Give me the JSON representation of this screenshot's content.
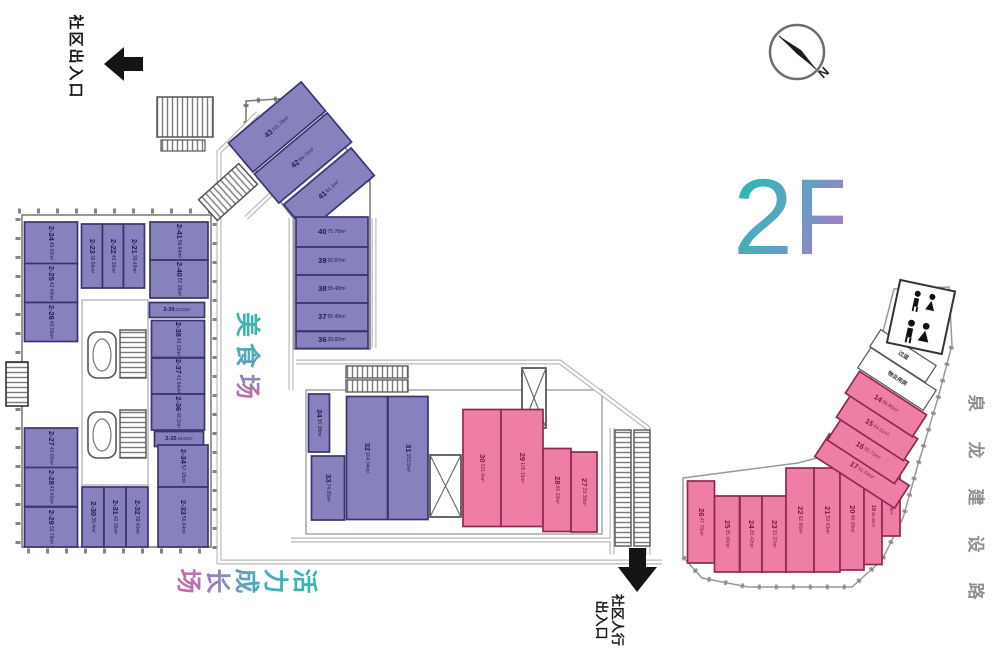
{
  "legend": {
    "floor_label": "2F",
    "north_label": "N",
    "entrance_top": "社区出入口",
    "entrance_bottom_line1": "社区人行",
    "entrance_bottom_line2": "出入口",
    "road_name": "泉龙建设路",
    "zone_food": "美食场",
    "zone_growth": "活力成长场"
  },
  "colors": {
    "purple_fill": "#8781bd",
    "purple_border": "#3c3470",
    "purple_text": "#221c4a",
    "pink_fill": "#ef7ea7",
    "pink_border": "#8e2a50",
    "pink_text": "#741c3c",
    "teal_accent": "#2eb8b0",
    "pink_accent": "#d1679e"
  },
  "plan": {
    "units": [
      {
        "label": "43",
        "area": "111.73m²",
        "color": "purple",
        "cx": 277,
        "cy": 127,
        "w": 95,
        "h": 38,
        "srot": -40,
        "lrot": -40
      },
      {
        "label": "42",
        "area": "64.71m²",
        "color": "purple",
        "cx": 303,
        "cy": 158,
        "w": 95,
        "h": 38,
        "srot": -40,
        "lrot": -40
      },
      {
        "label": "41",
        "area": "61.1m²",
        "color": "purple",
        "cx": 329,
        "cy": 190,
        "w": 88,
        "h": 36,
        "srot": -40,
        "lrot": -40
      },
      {
        "label": "40",
        "area": "75.76m²",
        "color": "purple",
        "cx": 332,
        "cy": 232,
        "w": 72,
        "h": 30,
        "lrot": 0
      },
      {
        "label": "39",
        "area": "56.87m²",
        "color": "purple",
        "cx": 332,
        "cy": 261,
        "w": 72,
        "h": 28,
        "lrot": 0
      },
      {
        "label": "38",
        "area": "55.48m²",
        "color": "purple",
        "cx": 332,
        "cy": 289,
        "w": 72,
        "h": 28,
        "lrot": 0
      },
      {
        "label": "37",
        "area": "55.49m²",
        "color": "purple",
        "cx": 332,
        "cy": 317,
        "w": 72,
        "h": 28,
        "lrot": 0
      },
      {
        "label": "36",
        "area": "39.82m²",
        "color": "purple",
        "cx": 332,
        "cy": 340,
        "w": 72,
        "h": 17,
        "lrot": 0
      },
      {
        "label": "2-24",
        "area": "49.92m²",
        "color": "purple",
        "cx": 51,
        "cy": 243,
        "w": 53,
        "h": 42,
        "lrot": 90
      },
      {
        "label": "2-23",
        "area": "39.56m²",
        "color": "purple",
        "cx": 92,
        "cy": 256,
        "w": 21,
        "h": 64,
        "lrot": 90
      },
      {
        "label": "2-22",
        "area": "40.35m²",
        "color": "purple",
        "cx": 113,
        "cy": 256,
        "w": 21,
        "h": 64,
        "lrot": 90
      },
      {
        "label": "2-21",
        "area": "39.49m²",
        "color": "purple",
        "cx": 134,
        "cy": 256,
        "w": 21,
        "h": 64,
        "lrot": 90
      },
      {
        "label": "2-41",
        "area": "56.64m²",
        "color": "purple",
        "cx": 179,
        "cy": 241,
        "w": 58,
        "h": 38,
        "lrot": 90
      },
      {
        "label": "2-40",
        "area": "57.35m²",
        "color": "purple",
        "cx": 179,
        "cy": 279,
        "w": 58,
        "h": 38,
        "lrot": 90
      },
      {
        "label": "2-39",
        "area": "22.02m²",
        "color": "purple",
        "cx": 177,
        "cy": 310,
        "w": 55,
        "h": 15,
        "lrot": 0,
        "small": true
      },
      {
        "label": "2-38",
        "area": "42.12m²",
        "color": "purple",
        "cx": 178,
        "cy": 339,
        "w": 53,
        "h": 37,
        "lrot": 90
      },
      {
        "label": "2-37",
        "area": "41.64m²",
        "color": "purple",
        "cx": 178,
        "cy": 376,
        "w": 53,
        "h": 36,
        "lrot": 90
      },
      {
        "label": "2-36",
        "area": "42.2m²",
        "color": "purple",
        "cx": 178,
        "cy": 412,
        "w": 53,
        "h": 36,
        "lrot": 90
      },
      {
        "label": "2-35",
        "area": "19.02m²",
        "color": "purple",
        "cx": 179,
        "cy": 439,
        "w": 49,
        "h": 15,
        "lrot": 0,
        "small": true
      },
      {
        "label": "2-25",
        "area": "42.40m²",
        "color": "purple",
        "cx": 51,
        "cy": 283,
        "w": 53,
        "h": 39,
        "lrot": 90
      },
      {
        "label": "2-26",
        "area": "40.00m²",
        "color": "purple",
        "cx": 51,
        "cy": 322,
        "w": 53,
        "h": 39,
        "lrot": 90
      },
      {
        "label": "2-27",
        "area": "40.00m²",
        "color": "purple",
        "cx": 51,
        "cy": 448,
        "w": 53,
        "h": 40,
        "lrot": 90
      },
      {
        "label": "2-28",
        "area": "42.40m²",
        "color": "purple",
        "cx": 51,
        "cy": 487,
        "w": 53,
        "h": 39,
        "lrot": 90
      },
      {
        "label": "2-29",
        "area": "33.79m²",
        "color": "purple",
        "cx": 51,
        "cy": 527,
        "w": 53,
        "h": 40,
        "lrot": 90
      },
      {
        "label": "2-30",
        "area": "39.4m²",
        "color": "purple",
        "cx": 93,
        "cy": 517,
        "w": 22,
        "h": 60,
        "lrot": 90
      },
      {
        "label": "2-31",
        "area": "42.35m²",
        "color": "purple",
        "cx": 115,
        "cy": 517,
        "w": 22,
        "h": 60,
        "lrot": 90
      },
      {
        "label": "2-32",
        "area": "39.40m²",
        "color": "purple",
        "cx": 137,
        "cy": 517,
        "w": 22,
        "h": 60,
        "lrot": 90
      },
      {
        "label": "2-34",
        "area": "57.15m²",
        "color": "purple",
        "cx": 183,
        "cy": 466,
        "w": 50,
        "h": 42,
        "lrot": 90
      },
      {
        "label": "2-33",
        "area": "56.64m²",
        "color": "purple",
        "cx": 183,
        "cy": 517,
        "w": 50,
        "h": 60,
        "lrot": 90
      },
      {
        "label": "34",
        "area": "36.38m²",
        "color": "purple",
        "cx": 319,
        "cy": 423,
        "w": 21,
        "h": 58,
        "lrot": 90
      },
      {
        "label": "33",
        "area": "74.05m²",
        "color": "purple",
        "cx": 328,
        "cy": 488,
        "w": 33,
        "h": 64,
        "lrot": 90
      },
      {
        "label": "32",
        "area": "104.04m²",
        "color": "purple",
        "cx": 367,
        "cy": 458,
        "w": 41,
        "h": 123,
        "lrot": 90
      },
      {
        "label": "31",
        "area": "102.5m²",
        "color": "purple",
        "cx": 408,
        "cy": 458,
        "w": 40,
        "h": 123,
        "lrot": 90
      },
      {
        "label": "30",
        "area": "101.6m²",
        "color": "pink",
        "cx": 482,
        "cy": 468,
        "w": 38,
        "h": 117,
        "lrot": 90
      },
      {
        "label": "29",
        "area": "105.16m²",
        "color": "pink",
        "cx": 522,
        "cy": 468,
        "w": 42,
        "h": 117,
        "lrot": 90
      },
      {
        "label": "28",
        "area": "66.19m²",
        "color": "pink",
        "cx": 557,
        "cy": 490,
        "w": 28,
        "h": 83,
        "lrot": 90
      },
      {
        "label": "27",
        "area": "29.38m²",
        "color": "pink",
        "cx": 584,
        "cy": 492,
        "w": 26,
        "h": 80,
        "lrot": 90
      },
      {
        "label": "26",
        "area": "47.76m²",
        "color": "pink",
        "cx": 701,
        "cy": 522,
        "w": 27,
        "h": 82,
        "lrot": 90
      },
      {
        "label": "25",
        "area": "35.06m²",
        "color": "pink",
        "cx": 727,
        "cy": 534,
        "w": 25,
        "h": 76,
        "lrot": 90
      },
      {
        "label": "24",
        "area": "28.42m²",
        "color": "pink",
        "cx": 751,
        "cy": 534,
        "w": 22,
        "h": 76,
        "lrot": 90
      },
      {
        "label": "23",
        "area": "33.37m²",
        "color": "pink",
        "cx": 774,
        "cy": 534,
        "w": 24,
        "h": 76,
        "lrot": 90
      },
      {
        "label": "22",
        "area": "62.66m²",
        "color": "pink",
        "cx": 800,
        "cy": 520,
        "w": 28,
        "h": 104,
        "lrot": 90
      },
      {
        "label": "21",
        "area": "59.43m²",
        "color": "pink",
        "cx": 827,
        "cy": 520,
        "w": 26,
        "h": 104,
        "lrot": 90
      },
      {
        "label": "20",
        "area": "48.08m²",
        "color": "pink",
        "cx": 852,
        "cy": 519,
        "w": 24,
        "h": 102,
        "lrot": 90
      },
      {
        "label": "19",
        "area": "39.36m²",
        "color": "pink",
        "cx": 873,
        "cy": 516,
        "w": 18,
        "h": 97,
        "lrot": 90,
        "small": true
      },
      {
        "label": "18",
        "area": "35.8m²",
        "color": "pink",
        "cx": 891,
        "cy": 505,
        "w": 18,
        "h": 62,
        "lrot": 90,
        "small": true
      },
      {
        "label": "17",
        "area": "51.54m²",
        "color": "pink",
        "cx": 862,
        "cy": 471,
        "w": 95,
        "h": 27,
        "srot": 33,
        "lrot": 33
      },
      {
        "label": "16",
        "area": "35.72m²",
        "color": "pink",
        "cx": 868,
        "cy": 451,
        "w": 80,
        "h": 26,
        "srot": 33,
        "lrot": 33
      },
      {
        "label": "15",
        "area": "43.11m²",
        "color": "pink",
        "cx": 877,
        "cy": 428,
        "w": 80,
        "h": 26,
        "srot": 33,
        "lrot": 33
      },
      {
        "label": "14",
        "area": "36.96m²",
        "color": "pink",
        "cx": 886,
        "cy": 404,
        "w": 80,
        "h": 26,
        "srot": 33,
        "lrot": 33
      },
      {
        "label": "物业用房",
        "area": "",
        "color": "white",
        "cx": 897,
        "cy": 379,
        "w": 78,
        "h": 24,
        "srot": 33,
        "lrot": 33,
        "small": true
      },
      {
        "label": "过道",
        "area": "",
        "color": "white",
        "cx": 903,
        "cy": 356,
        "w": 66,
        "h": 20,
        "srot": 33,
        "lrot": 33,
        "small": true
      }
    ]
  }
}
